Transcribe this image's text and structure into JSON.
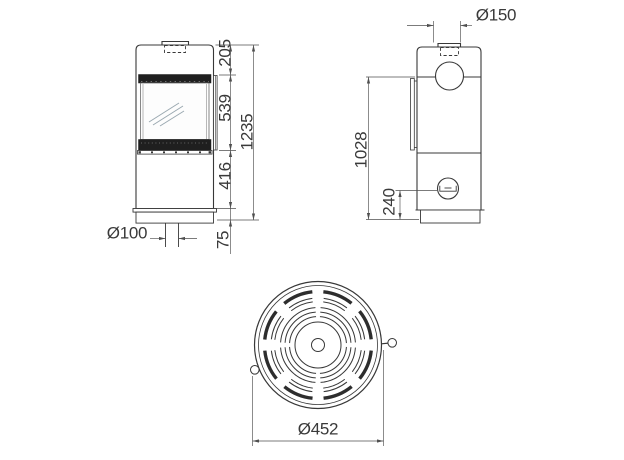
{
  "colors": {
    "background": "#ffffff",
    "line": "#383838",
    "dim_line": "#4f4f4f",
    "dark_band": "#1f1f1f",
    "glass_reflection": "#9aa8b0"
  },
  "views": {
    "front": {
      "name": "front-view",
      "dims": {
        "top_section": "205",
        "door_height": "539",
        "lower_section": "416",
        "base_height": "75",
        "total_height": "1235",
        "floor_duct": "Ø100"
      }
    },
    "side": {
      "name": "side-view",
      "dims": {
        "flue_diameter": "Ø150",
        "flue_center_height": "1028",
        "air_inlet_height": "240"
      }
    },
    "top": {
      "name": "top-view",
      "dims": {
        "body_diameter": "Ø452"
      }
    }
  }
}
